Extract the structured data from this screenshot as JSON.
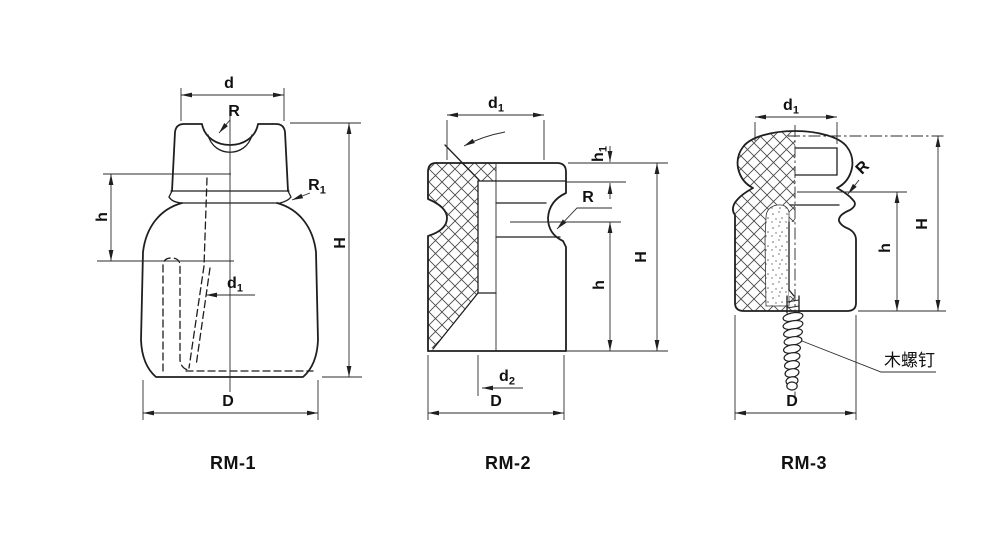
{
  "drawing": {
    "background": "#ffffff",
    "line_color": "#1f1f1f",
    "figures": [
      {
        "caption": "RM-1",
        "labels": {
          "d": {
            "base": "d",
            "sub": ""
          },
          "R": {
            "base": "R",
            "sub": ""
          },
          "R1": {
            "base": "R",
            "sub": "1"
          },
          "h": {
            "base": "h",
            "sub": ""
          },
          "H": {
            "base": "H",
            "sub": ""
          },
          "d1": {
            "base": "d",
            "sub": "1"
          },
          "D": {
            "base": "D",
            "sub": ""
          }
        }
      },
      {
        "caption": "RM-2",
        "labels": {
          "d1": {
            "base": "d",
            "sub": "1"
          },
          "h1": {
            "base": "h",
            "sub": "1"
          },
          "R": {
            "base": "R",
            "sub": ""
          },
          "h": {
            "base": "h",
            "sub": ""
          },
          "H": {
            "base": "H",
            "sub": ""
          },
          "d2": {
            "base": "d",
            "sub": "2"
          },
          "D": {
            "base": "D",
            "sub": ""
          }
        }
      },
      {
        "caption": "RM-3",
        "labels": {
          "d1": {
            "base": "d",
            "sub": "1"
          },
          "R": {
            "base": "R",
            "sub": ""
          },
          "h": {
            "base": "h",
            "sub": ""
          },
          "H": {
            "base": "H",
            "sub": ""
          },
          "D": {
            "base": "D",
            "sub": ""
          }
        },
        "annotation": "木螺钉"
      }
    ]
  }
}
